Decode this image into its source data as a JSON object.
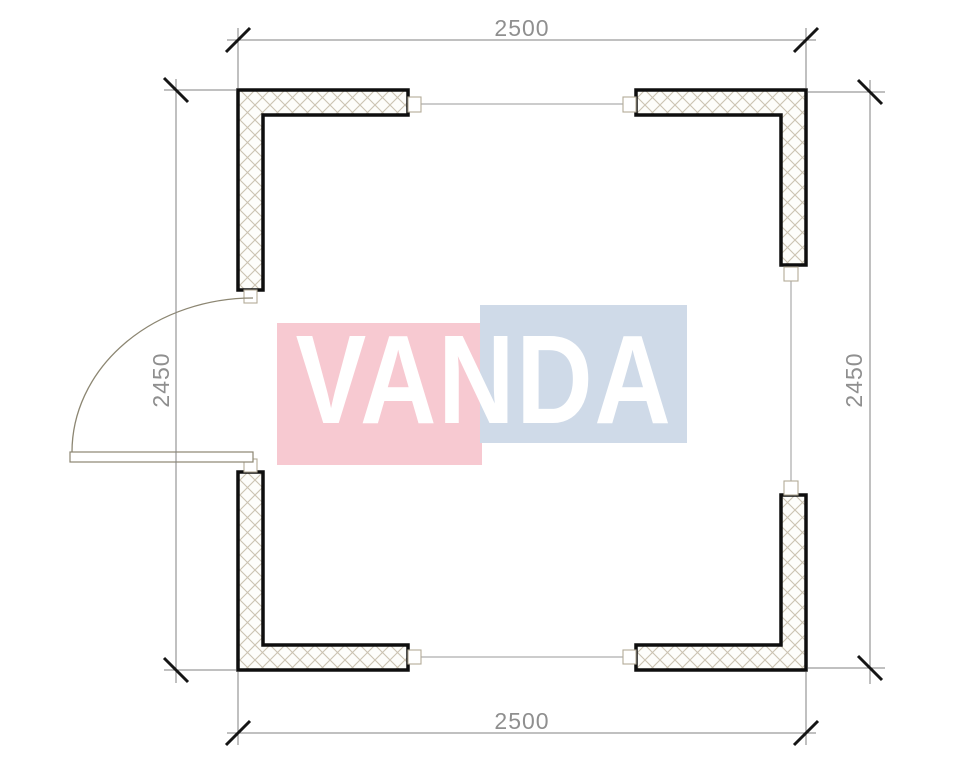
{
  "drawing": {
    "type": "floor-plan",
    "dimensions": {
      "top": "2500",
      "bottom": "2500",
      "left": "2450",
      "right": "2450"
    },
    "watermark": {
      "text": "VANDA",
      "pink_color": "#f7c9d1",
      "blue_color": "#cfdae8",
      "text_color": "#ffffff"
    },
    "colors": {
      "wall_outline": "#0e0e0e",
      "wall_hatch": "#cbc3b1",
      "dimension_line": "#828282",
      "dimension_text": "#8f8f8f",
      "tick": "#151515",
      "door": "#8c8672"
    }
  }
}
